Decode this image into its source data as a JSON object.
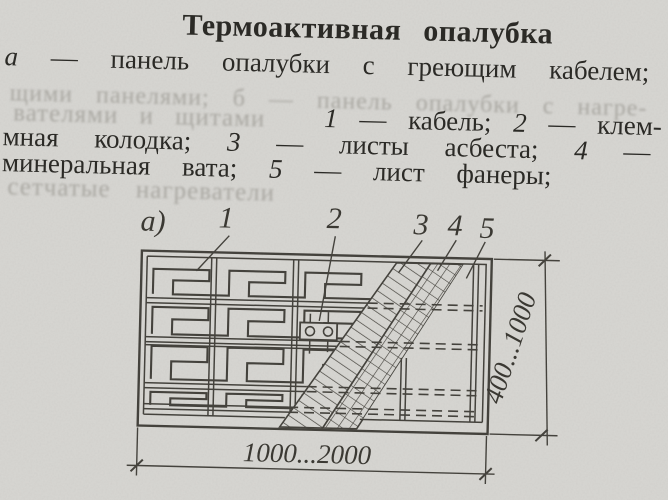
{
  "title": "Термоактивная опалубка",
  "caption": {
    "label_a": "а",
    "line_a": "— панель опалубки с греющим кабелем;",
    "faded_mid": "щими панелями; б — панель опалубки с нагре-",
    "faded_left": "вателями и щитами",
    "item1_num": "1",
    "item1_text": "— кабель;",
    "item2_num": "2",
    "item2_text": "— клем-",
    "line_c_start": "мная колодка;",
    "item3_num": "3",
    "item3_text": "— листы асбеста;",
    "item4_num": "4",
    "item4_text": "—",
    "line_d_start": "минеральная вата;",
    "item5_num": "5",
    "item5_text": "— лист фанеры;",
    "faded_bottom": "сетчатые нагреватели"
  },
  "figure": {
    "label": "а)",
    "callouts": [
      "1",
      "2",
      "3",
      "4",
      "5"
    ],
    "dim_width": "1000...2000",
    "dim_height": "400...1000"
  },
  "colors": {
    "paper": "#d7d6d2",
    "ink": "#2b2a26",
    "line": "#45433d"
  }
}
